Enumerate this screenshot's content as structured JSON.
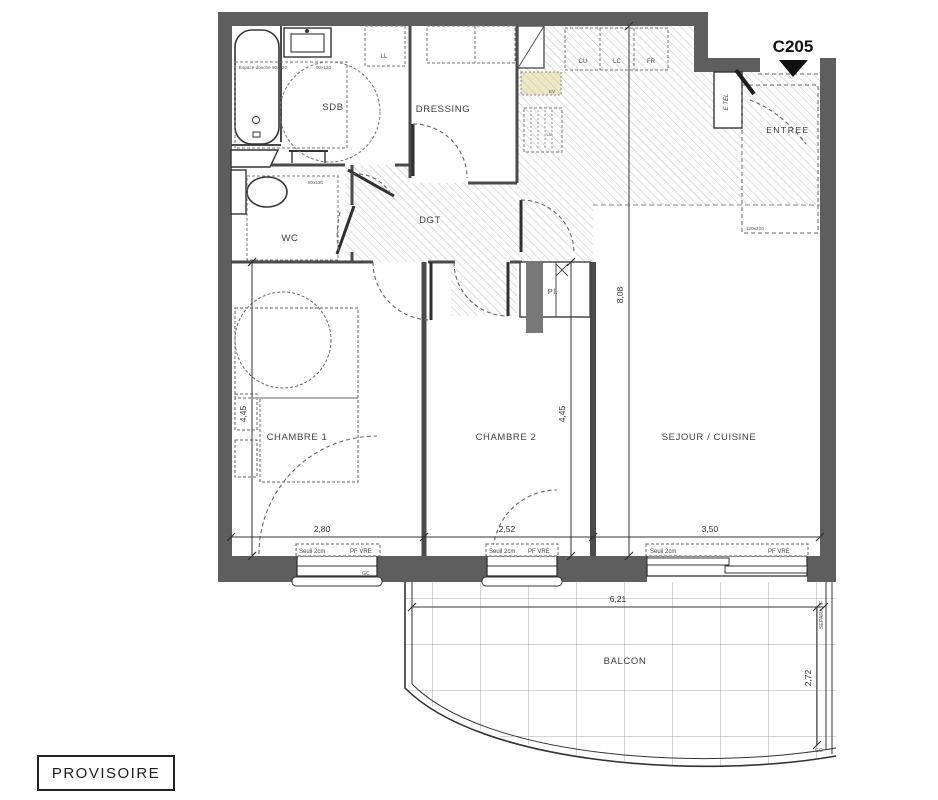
{
  "plan": {
    "unit_id": "C205",
    "stamp": "PROVISOIRE",
    "rooms": {
      "sdb": "SDB",
      "dressing": "DRESSING",
      "wc": "WC",
      "dgt": "DGT",
      "entree": "ENTREE",
      "placard": "Pl.",
      "chambre1": "CHAMBRE 1",
      "chambre2": "CHAMBRE 2",
      "sejour": "SEJOUR / CUISINE",
      "balcon": "BALCON"
    },
    "appliances": {
      "ll": "LL",
      "cu": "CU",
      "lc": "LC",
      "fr": "FR",
      "ev": "EV",
      "lv": "LV",
      "etel": "E.TEL"
    },
    "annotations": {
      "espace_douche": "Espace douche 90x120",
      "douche_size": "90x120",
      "wc_size": "80x130",
      "entry_size": "120x220",
      "separatif": "SEPARATIF",
      "gc_window": "GC",
      "gc_balcony": "GC"
    },
    "dimensions": {
      "sejour_h": "8,08",
      "ch1_h": "4,45",
      "ch2_h": "4,45",
      "ch1_w": "2,80",
      "ch2_w": "2,52",
      "sejour_w": "3,50",
      "balcon_w": "6,21",
      "balcon_d": "2,72"
    },
    "windows": {
      "w1": {
        "seuil": "Seuil 2cm",
        "type": "PF VRE"
      },
      "w2": {
        "seuil": "Seuil 2cm",
        "type": "PF VRE"
      },
      "w3": {
        "seuil": "Seuil 2cm",
        "type": "PF VRE"
      }
    },
    "colors": {
      "wall": "#5e5e5e",
      "line": "#3a3a3a",
      "hatch": "#c4c4c4",
      "sink_highlight": "#ece7c0"
    }
  }
}
